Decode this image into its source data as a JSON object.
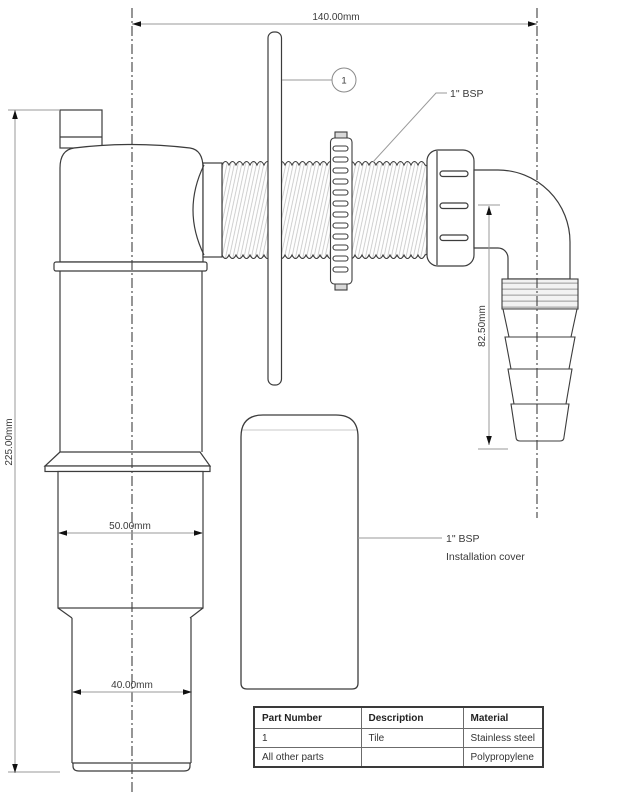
{
  "drawing": {
    "dimensions": {
      "overall_width": "140.00mm",
      "overall_height": "225.00mm",
      "outlet_drop": "82.50mm",
      "upper_pipe_diameter": "50.00mm",
      "lower_pipe_diameter": "40.00mm"
    },
    "labels": {
      "bsp_thread": "1\" BSP",
      "cover_line1": "1\" BSP",
      "cover_line2": "Installation cover",
      "callout_number": "1"
    }
  },
  "table": {
    "headers": [
      "Part Number",
      "Description",
      "Material"
    ],
    "rows": [
      [
        "1",
        "Tile",
        "Stainless steel"
      ],
      [
        "All other parts",
        "",
        "Polypropylene"
      ]
    ]
  },
  "colors": {
    "object_line": "#3c3c3c",
    "dimension_line": "#9a9a9a",
    "hatch": "#c4c4c4",
    "text": "#3a3a3a"
  }
}
